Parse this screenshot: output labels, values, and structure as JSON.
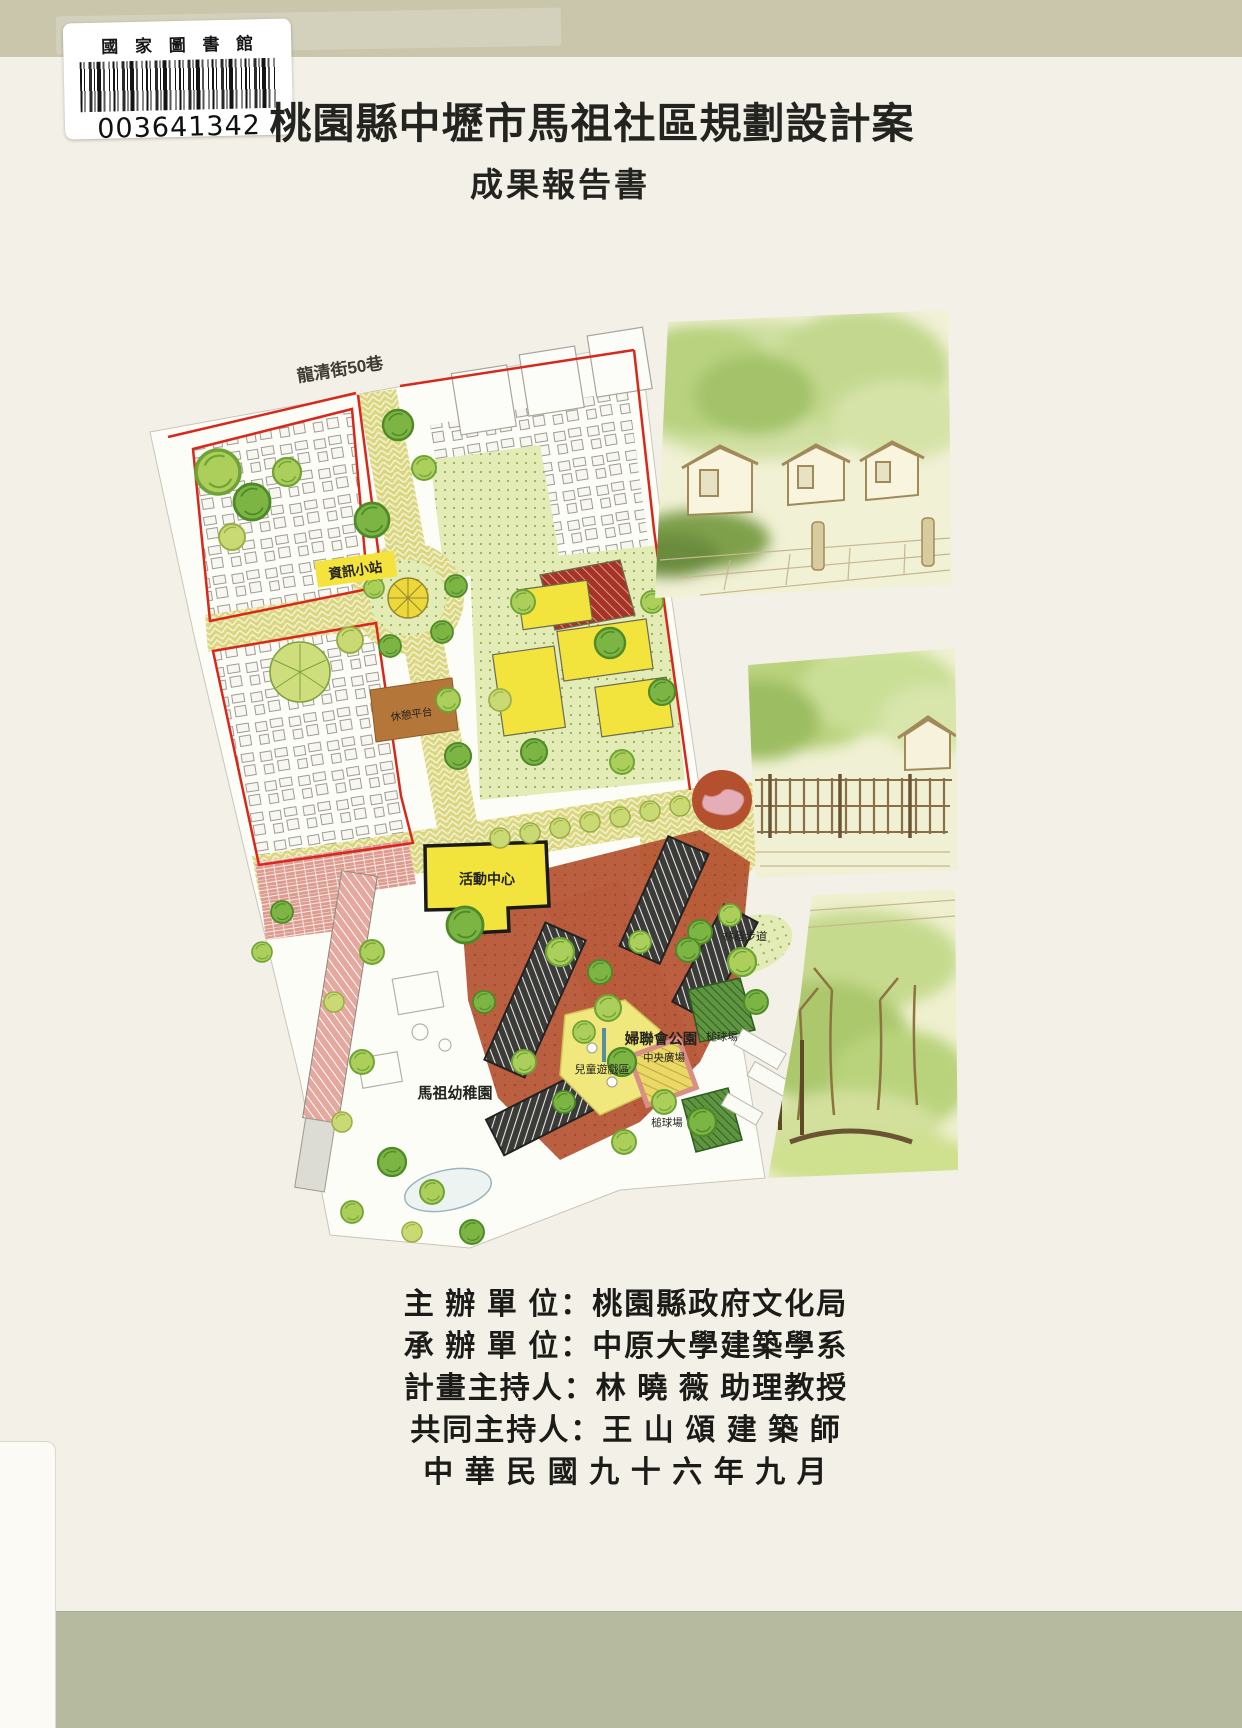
{
  "library_label": {
    "institution": "國 家 圖 書 館",
    "barcode_number": "003641342"
  },
  "cover": {
    "title": "桃園縣中壢市馬祖社區規劃設計案",
    "subtitle": "成果報告書"
  },
  "site_plan": {
    "streets": {
      "lane50": "龍清街50巷",
      "longqing": "龍清街"
    },
    "labels": {
      "info_station": "資訊小站",
      "rest_deck": "休憩平台",
      "activity_center": "活動中心",
      "kindergarten": "馬祖幼稚園",
      "children_play_zone": "兒童遊戲區",
      "womens_league_park": "婦聯會公園",
      "central_plaza": "中央廣場",
      "croquet_upper": "槌球場",
      "croquet_lower": "槌球場",
      "shaded_walk": "林蔭步道"
    }
  },
  "credits": {
    "lines": [
      "主 辦 單 位：桃園縣政府文化局",
      "承 辦 單 位：中原大學建築學系",
      "計畫主持人：林 曉 薇 助理教授",
      "共同主持人：王 山 頌 建 築 師",
      "中 華 民 國 九 十 六 年 九 月"
    ]
  },
  "colors": {
    "band_top": "#c9c6ab",
    "band_bottom": "#b6ba9f",
    "paper": "#f3f0e7",
    "boundary_red": "#d8281c",
    "road_yellow": "#d9d67f",
    "building_yellow": "#f2e43c",
    "plaza_terracotta": "#b4512f"
  }
}
